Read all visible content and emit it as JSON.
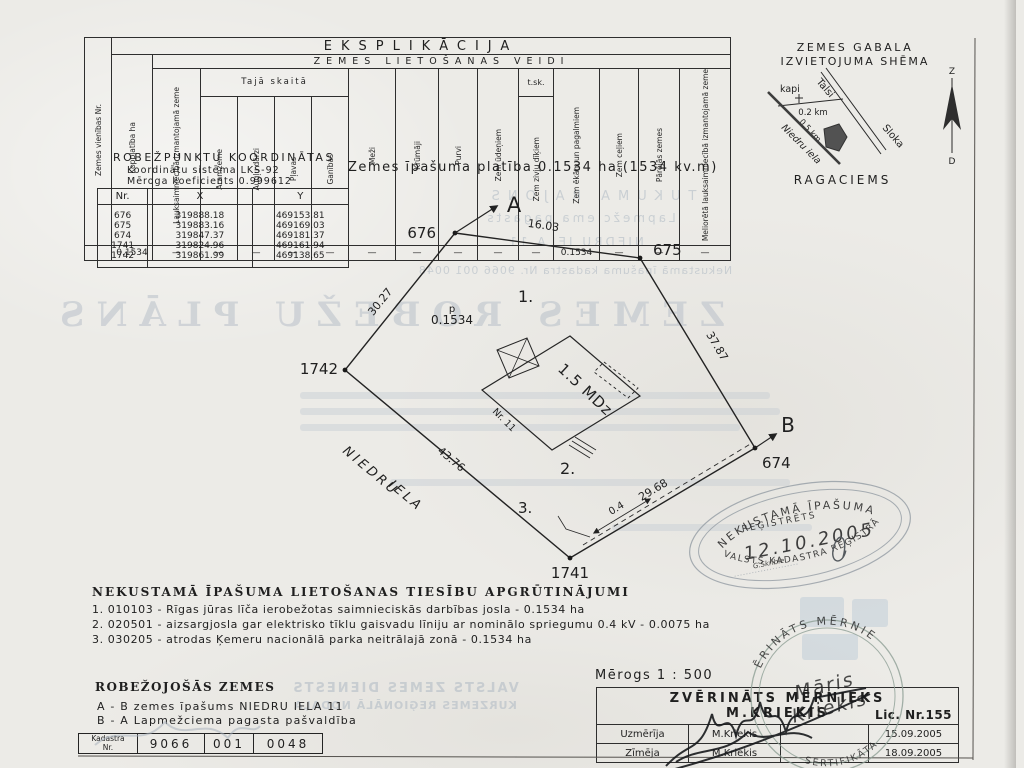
{
  "explication": {
    "title": "EKSPLIKĀCIJA",
    "subtitle": "ZEMES LIETOŠANAS VEIDI",
    "taja": "Tajā skaitā",
    "tsk": "t.sk.",
    "headers": [
      "Zemes vienības Nr.",
      "Kopplatība ha",
      "Lauksaimniecībā izmantojamā zeme",
      "Aramzeme",
      "Augļu dārzi",
      "Pļavas",
      "Ganības",
      "Meži",
      "Krūmāji",
      "Purvi",
      "Zem ūdeņiem",
      "Zem zivju dīķiem",
      "Zem ēkām un pagalmiem",
      "Zem ceļiem",
      "Pārējās zemes",
      "Meliorētā lauksaimniecībā izmantojamā zeme"
    ],
    "row": [
      "",
      "0.1534",
      "—",
      "—",
      "—",
      "—",
      "—",
      "—",
      "—",
      "—",
      "—",
      "—",
      "0.1534",
      "—",
      "—",
      "—"
    ]
  },
  "coords": {
    "title": "ROBEŽPUNKTU KOORDINĀTAS",
    "line1": "Koordinātu sistēma LKS-92",
    "line2": "Mēroga koeficients 0.999612",
    "headers": [
      "Nr.",
      "X",
      "Y"
    ],
    "rows": [
      [
        "676",
        "319888.18",
        "469153.81"
      ],
      [
        "675",
        "319883.16",
        "469169.03"
      ],
      [
        "674",
        "319847.37",
        "469181.37"
      ],
      [
        "1741",
        "319824.96",
        "469161.94"
      ],
      [
        "1742",
        "319861.99",
        "469138.65"
      ]
    ]
  },
  "area_statement": "Zemes īpašuma platība 0.1534 ha (1534 kv.m)",
  "location_schema": {
    "title_line1": "ZEMES GABALA",
    "title_line2": "IZVIETOJUMA SHĒMA",
    "cemetery": "kapi",
    "road_to": "Talsi",
    "road_from": "Sloka",
    "dist1": "0.2 km",
    "dist2": "0.5 km",
    "street": "Niedru iela",
    "village": "RAGACIEMS",
    "compass_north": "Z",
    "compass_south": "D"
  },
  "plan": {
    "point_a": "A",
    "point_b": "B",
    "v676": "676",
    "v675": "675",
    "v674": "674",
    "v1741": "1741",
    "v1742": "1742",
    "len_676_675": "16.03",
    "len_675_674": "37.87",
    "len_674_1741": "29.68",
    "len_1741_1742": "43.76",
    "len_1742_676": "30.27",
    "zone1": "1.",
    "zone2": "2.",
    "zone3": "3.",
    "p_label": "p",
    "p_area": "0.1534",
    "building": "1.5 MDz",
    "house_no": "Nr. 11",
    "street_1": "NIEDRU",
    "street_2": "IELA",
    "offset": "0.4"
  },
  "encumbrances": {
    "title": "NEKUSTAMĀ ĪPAŠUMA LIETOŠANAS TIESĪBU APGRŪTINĀJUMI",
    "item1": "1. 010103  -  Rīgas jūras līča ierobežotas saimnieciskās darbības josla  -  0.1534 ha",
    "item2": "2. 020501 -  aizsargjosla gar elektrisko tīklu gaisvadu līniju ar nominālo spriegumu 0.4 kV  -  0.0075 ha",
    "item3": "3. 030205  -  atrodas Ķemeru nacionālā parka neitrālajā zonā  -  0.1534 ha"
  },
  "bordering": {
    "title": "ROBEŽOJOŠĀS ZEMES",
    "item1": "A  -  B  zemes īpašums NIEDRU IELA 11",
    "item2": "B  -  A  Lapmežciema pagasta pašvaldība"
  },
  "cadastre": {
    "label_line1": "Kadastra",
    "label_line2": "Nr.",
    "part1": "9066",
    "part2": "001",
    "part3": "0048"
  },
  "scale": "Mērogs 1 : 500",
  "surveyor": {
    "title": "ZVĒRINĀTS MĒRNIEKS",
    "name": "M.KRIEKIS",
    "licence": "Lic. Nr.155",
    "row1_role": "Uzmērīja",
    "row1_name": "M.Kriekis",
    "row1_date": "15.09.2005",
    "row2_role": "Zīmēja",
    "row2_name": "M.Kriekis",
    "row2_date": "18.09.2005"
  },
  "stamps": {
    "registry_top": "NEKUSTAMĀ ĪPAŠUMA",
    "registry_mid": "REĢISTRĒTS",
    "registry_date": "12.10.2005",
    "registry_clerk": "G.Skrible",
    "registry_bottom": "VALSTS KADASTRA REĢISTRĀ",
    "surveyor_top": "ZVĒRINĀTS MĒRNIEKS",
    "surveyor_bottom": "SERTIFIKĀTA",
    "surveyor_name1": "Māris",
    "surveyor_name2": "Kriekis"
  },
  "ghosts": {
    "g1": "TUKUMA RAJONS",
    "g2": "Lapmežciema pagasts",
    "g3": "NIEDRU IELA 11",
    "g4": "Nekustamā īpašuma kadastra Nr.  9066 001 0048",
    "g5": "ZEMES ROBEŽU PLĀNS",
    "g6": "VALSTS ZEMES DIENESTS",
    "g7": "KURZEMES REĢIONĀLĀ NODAĻA"
  },
  "colors": {
    "ink": "#1f1f1f",
    "paper": "#ecebe7",
    "ghost": "#b5bec7",
    "stamp_gray": "#99a1a8",
    "stamp_green": "#84988c"
  }
}
